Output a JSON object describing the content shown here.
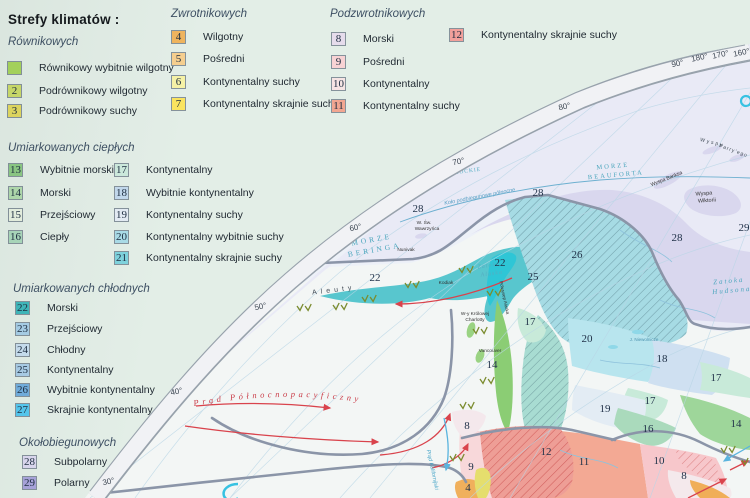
{
  "legend": {
    "title": {
      "text": "Strefy klimatów :",
      "x": 8,
      "y": 12
    },
    "groups": [
      {
        "header": {
          "text": "Równikowych",
          "x": 8,
          "y": 36
        },
        "items": [
          {
            "num": "",
            "label": "Równikowy wybitnie wilgotny",
            "color": "#a8d65c",
            "x": 7,
            "y": 61
          },
          {
            "num": "2",
            "label": "Podrównikowy wilgotny",
            "color": "#ccdc6a",
            "x": 7,
            "y": 84
          },
          {
            "num": "3",
            "label": "Podrównikowy suchy",
            "color": "#e3da60",
            "x": 7,
            "y": 104
          }
        ]
      },
      {
        "header": {
          "text": "Zwrotnikowych",
          "x": 171,
          "y": 8
        },
        "items": [
          {
            "num": "4",
            "label": "Wilgotny",
            "color": "#f0b55e",
            "x": 171,
            "y": 30
          },
          {
            "num": "5",
            "label": "Pośredni",
            "color": "#f6cf8f",
            "x": 171,
            "y": 52
          },
          {
            "num": "6",
            "label": "Kontynentalny suchy",
            "color": "#f6f2a6",
            "x": 171,
            "y": 75
          },
          {
            "num": "7",
            "label": "Kontynentalny skrajnie suchy",
            "color": "#fbe45f",
            "x": 171,
            "y": 97
          }
        ]
      },
      {
        "header": {
          "text": "Podzwrotnikowych",
          "x": 330,
          "y": 8
        },
        "items": [
          {
            "num": "8",
            "label": "Morski",
            "color": "#e6dcec",
            "x": 331,
            "y": 32
          },
          {
            "num": "9",
            "label": "Pośredni",
            "color": "#f8d2d4",
            "x": 331,
            "y": 55
          },
          {
            "num": "10",
            "label": "Kontynentalny",
            "color": "#f6e4e4",
            "x": 331,
            "y": 77
          },
          {
            "num": "11",
            "label": "Kontynentalny suchy",
            "color": "#f2a691",
            "x": 331,
            "y": 99
          }
        ]
      },
      {
        "header": null,
        "items": [
          {
            "num": "12",
            "label": "Kontynentalny skrajnie suchy",
            "color": "#f2a09b",
            "x": 449,
            "y": 28
          }
        ]
      },
      {
        "header": {
          "text": "Umiarkowanych ciepłych",
          "x": 8,
          "y": 142
        },
        "items": [
          {
            "num": "13",
            "label": "Wybitnie morski",
            "color": "#8cca84",
            "x": 8,
            "y": 163
          },
          {
            "num": "14",
            "label": "Morski",
            "color": "#b2dcae",
            "x": 8,
            "y": 186
          },
          {
            "num": "15",
            "label": "Przejściowy",
            "color": "#e8f2e2",
            "x": 8,
            "y": 208
          },
          {
            "num": "16",
            "label": "Ciepły",
            "color": "#abd9bc",
            "x": 8,
            "y": 230
          },
          {
            "num": "17",
            "label": "Kontynentalny",
            "color": "#cdeadd",
            "x": 114,
            "y": 163
          },
          {
            "num": "18",
            "label": "Wybitnie kontynentalny",
            "color": "#c3d9ed",
            "x": 114,
            "y": 186
          },
          {
            "num": "19",
            "label": "Kontynentalny suchy",
            "color": "#e4ecf4",
            "x": 114,
            "y": 208
          },
          {
            "num": "20",
            "label": "Kontynentalny wybitnie suchy",
            "color": "#aadce8",
            "x": 114,
            "y": 230
          },
          {
            "num": "21",
            "label": "Kontynentalny skrajnie suchy",
            "color": "#7fd3de",
            "x": 114,
            "y": 251
          }
        ]
      },
      {
        "header": {
          "text": "Umiarkowanych chłodnych",
          "x": 13,
          "y": 283
        },
        "items": [
          {
            "num": "22",
            "label": "Morski",
            "color": "#3eb8bc",
            "x": 15,
            "y": 301
          },
          {
            "num": "23",
            "label": "Przejściowy",
            "color": "#a8cfe8",
            "x": 15,
            "y": 322
          },
          {
            "num": "24",
            "label": "Chłodny",
            "color": "#c8dff0",
            "x": 15,
            "y": 343
          },
          {
            "num": "25",
            "label": "Kontynentalny",
            "color": "#aacde8",
            "x": 15,
            "y": 363
          },
          {
            "num": "26",
            "label": "Wybitnie kontynentalny",
            "color": "#72aede",
            "x": 15,
            "y": 383
          },
          {
            "num": "27",
            "label": "Skrajnie kontynentalny",
            "color": "#55c8f0",
            "x": 15,
            "y": 403
          }
        ]
      },
      {
        "header": {
          "text": "Okołobiegunowych",
          "x": 19,
          "y": 437
        },
        "items": [
          {
            "num": "28",
            "label": "Subpolarny",
            "color": "#dcd8f0",
            "x": 22,
            "y": 455
          },
          {
            "num": "29",
            "label": "Polarny",
            "color": "#a9a4dc",
            "x": 22,
            "y": 476
          }
        ]
      }
    ]
  },
  "map": {
    "graticule_labels": [
      {
        "t": "30°",
        "x": 109,
        "y": 484
      },
      {
        "t": "40°",
        "x": 177,
        "y": 394
      },
      {
        "t": "50°",
        "x": 261,
        "y": 309
      },
      {
        "t": "60°",
        "x": 356,
        "y": 230
      },
      {
        "t": "70°",
        "x": 459,
        "y": 164
      },
      {
        "t": "80°",
        "x": 565,
        "y": 109
      },
      {
        "t": "90°",
        "x": 678,
        "y": 66
      },
      {
        "t": "180°",
        "x": 700,
        "y": 60
      },
      {
        "t": "170°",
        "x": 721,
        "y": 57
      },
      {
        "t": "160°",
        "x": 742,
        "y": 55
      }
    ],
    "zone_numbers": [
      {
        "n": "28",
        "x": 418,
        "y": 212
      },
      {
        "n": "28",
        "x": 538,
        "y": 196
      },
      {
        "n": "28",
        "x": 677,
        "y": 241
      },
      {
        "n": "29",
        "x": 744,
        "y": 231
      },
      {
        "n": "26",
        "x": 577,
        "y": 258
      },
      {
        "n": "22",
        "x": 375,
        "y": 281
      },
      {
        "n": "22",
        "x": 500,
        "y": 266
      },
      {
        "n": "25",
        "x": 533,
        "y": 280
      },
      {
        "n": "17",
        "x": 530,
        "y": 325
      },
      {
        "n": "17",
        "x": 716,
        "y": 381
      },
      {
        "n": "17",
        "x": 650,
        "y": 404
      },
      {
        "n": "20",
        "x": 587,
        "y": 342
      },
      {
        "n": "18",
        "x": 662,
        "y": 362
      },
      {
        "n": "14",
        "x": 492,
        "y": 368
      },
      {
        "n": "14",
        "x": 736,
        "y": 427
      },
      {
        "n": "19",
        "x": 605,
        "y": 412
      },
      {
        "n": "16",
        "x": 648,
        "y": 432
      },
      {
        "n": "8",
        "x": 467,
        "y": 429
      },
      {
        "n": "8",
        "x": 684,
        "y": 479
      },
      {
        "n": "12",
        "x": 546,
        "y": 455
      },
      {
        "n": "11",
        "x": 584,
        "y": 465
      },
      {
        "n": "10",
        "x": 659,
        "y": 464
      },
      {
        "n": "9",
        "x": 471,
        "y": 470
      },
      {
        "n": "4",
        "x": 468,
        "y": 491
      }
    ],
    "sea_labels": [
      {
        "lines": [
          "MORZE",
          "CZUKOCKIE"
        ],
        "x": 458,
        "y": 166,
        "s": 5.5,
        "ls": 1,
        "r": -8,
        "c": "#55aec2"
      },
      {
        "lines": [
          "MORZE",
          "BERINGA"
        ],
        "x": 372,
        "y": 242,
        "s": 7.5,
        "ls": 3,
        "r": -10,
        "c": "#4ba6bd"
      },
      {
        "lines": [
          "MORZE",
          "BEAUFORTA"
        ],
        "x": 613,
        "y": 168,
        "s": 6.5,
        "ls": 2,
        "r": -5,
        "c": "#4ba6bd"
      },
      {
        "lines": [
          "Zatoka",
          "Alaska"
        ],
        "x": 489,
        "y": 267,
        "s": 6,
        "ls": 1,
        "r": -8,
        "c": "#55aec2",
        "it": true
      },
      {
        "lines": [
          "Zatoka",
          "Hudsona"
        ],
        "x": 729,
        "y": 283,
        "s": 7,
        "ls": 2,
        "r": -5,
        "c": "#4ba6bd",
        "it": true
      }
    ],
    "place_labels": [
      {
        "t": "W. Św.",
        "x": 424,
        "y": 224,
        "s": 4.8
      },
      {
        "t": "Wawrzyńca",
        "x": 427,
        "y": 230,
        "s": 4.8
      },
      {
        "t": "Nunivak",
        "x": 406,
        "y": 251,
        "s": 4.8
      },
      {
        "t": "Aleuty",
        "x": 334,
        "y": 292,
        "s": 7,
        "r": -7,
        "ls": 4,
        "c": "#3f4a55"
      },
      {
        "t": "Kodiak",
        "x": 446,
        "y": 284,
        "s": 4.8
      },
      {
        "t": "W-y Królowej",
        "x": 475,
        "y": 315,
        "s": 4.8
      },
      {
        "t": "Charlotty",
        "x": 475,
        "y": 321,
        "s": 4.8
      },
      {
        "t": "Vancouver",
        "x": 490,
        "y": 352,
        "s": 4.8
      },
      {
        "t": "Wyspa Banksa",
        "x": 667,
        "y": 180,
        "s": 5,
        "r": -22
      },
      {
        "t": "Wyspa",
        "x": 704,
        "y": 195,
        "s": 5.5,
        "r": -4,
        "serif": true
      },
      {
        "t": "Wiktorii",
        "x": 707,
        "y": 202,
        "s": 5.5,
        "r": -4,
        "serif": true
      },
      {
        "t": "Wyspy",
        "x": 712,
        "y": 144,
        "s": 5,
        "r": 14,
        "ls": 2,
        "c": "#3f4a55"
      },
      {
        "t": "Parry'ego",
        "x": 733,
        "y": 152,
        "s": 5,
        "r": 20,
        "ls": 1,
        "c": "#3f4a55"
      },
      {
        "t": "J. Niewolnicze",
        "x": 644,
        "y": 341,
        "s": 4.5,
        "c": "#4a92ae"
      },
      {
        "t": "Półwysep Alaska",
        "x": 503,
        "y": 298,
        "s": 4.5,
        "r": 78
      },
      {
        "t": "Koło podbiegunowe północne",
        "x": 480,
        "y": 198,
        "s": 5.5,
        "r": -11,
        "c": "#579fc4",
        "it": true
      },
      {
        "t": "Prąd Kalifornijski",
        "x": 431,
        "y": 470,
        "s": 5.5,
        "r": 78,
        "c": "#4aa6c8",
        "it": true
      }
    ],
    "current_label": {
      "t": "Prąd Północnopacyficzny"
    },
    "symbol_positions": [
      {
        "x": 297,
        "y": 306
      },
      {
        "x": 333,
        "y": 305
      },
      {
        "x": 362,
        "y": 297
      },
      {
        "x": 405,
        "y": 283
      },
      {
        "x": 459,
        "y": 268
      },
      {
        "x": 487,
        "y": 291
      },
      {
        "x": 473,
        "y": 329
      },
      {
        "x": 480,
        "y": 379
      },
      {
        "x": 460,
        "y": 404
      },
      {
        "x": 450,
        "y": 456
      },
      {
        "x": 721,
        "y": 448
      },
      {
        "x": 742,
        "y": 460
      }
    ],
    "colors": {
      "legend_bg": "#e3eee7",
      "ocean": "#f3f6f5",
      "polar": "#e9eaf6",
      "polar_land": "#d9d7ee",
      "marine_cold": "#58c6ce",
      "hatched_mountain": "#a6dbe4",
      "warm_red": "#d9434c",
      "cold_blue": "#5ab4de"
    }
  }
}
